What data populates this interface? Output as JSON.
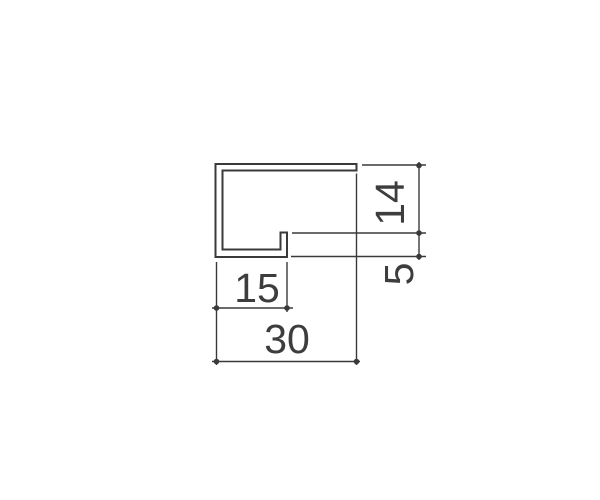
{
  "window": {
    "background_color": "#ffffff"
  },
  "drawing": {
    "kind": "profile-cross-section-dimension-drawing",
    "stroke_color": "#3a3a3a",
    "text_color": "#3d3d3d",
    "dimensions": {
      "upper_height": {
        "label": "14",
        "orientation": "vertical"
      },
      "lip_height": {
        "label": "5",
        "orientation": "vertical"
      },
      "bottom_flange_width": {
        "label": "15",
        "orientation": "horizontal"
      },
      "overall_width": {
        "label": "30",
        "orientation": "horizontal"
      }
    }
  }
}
